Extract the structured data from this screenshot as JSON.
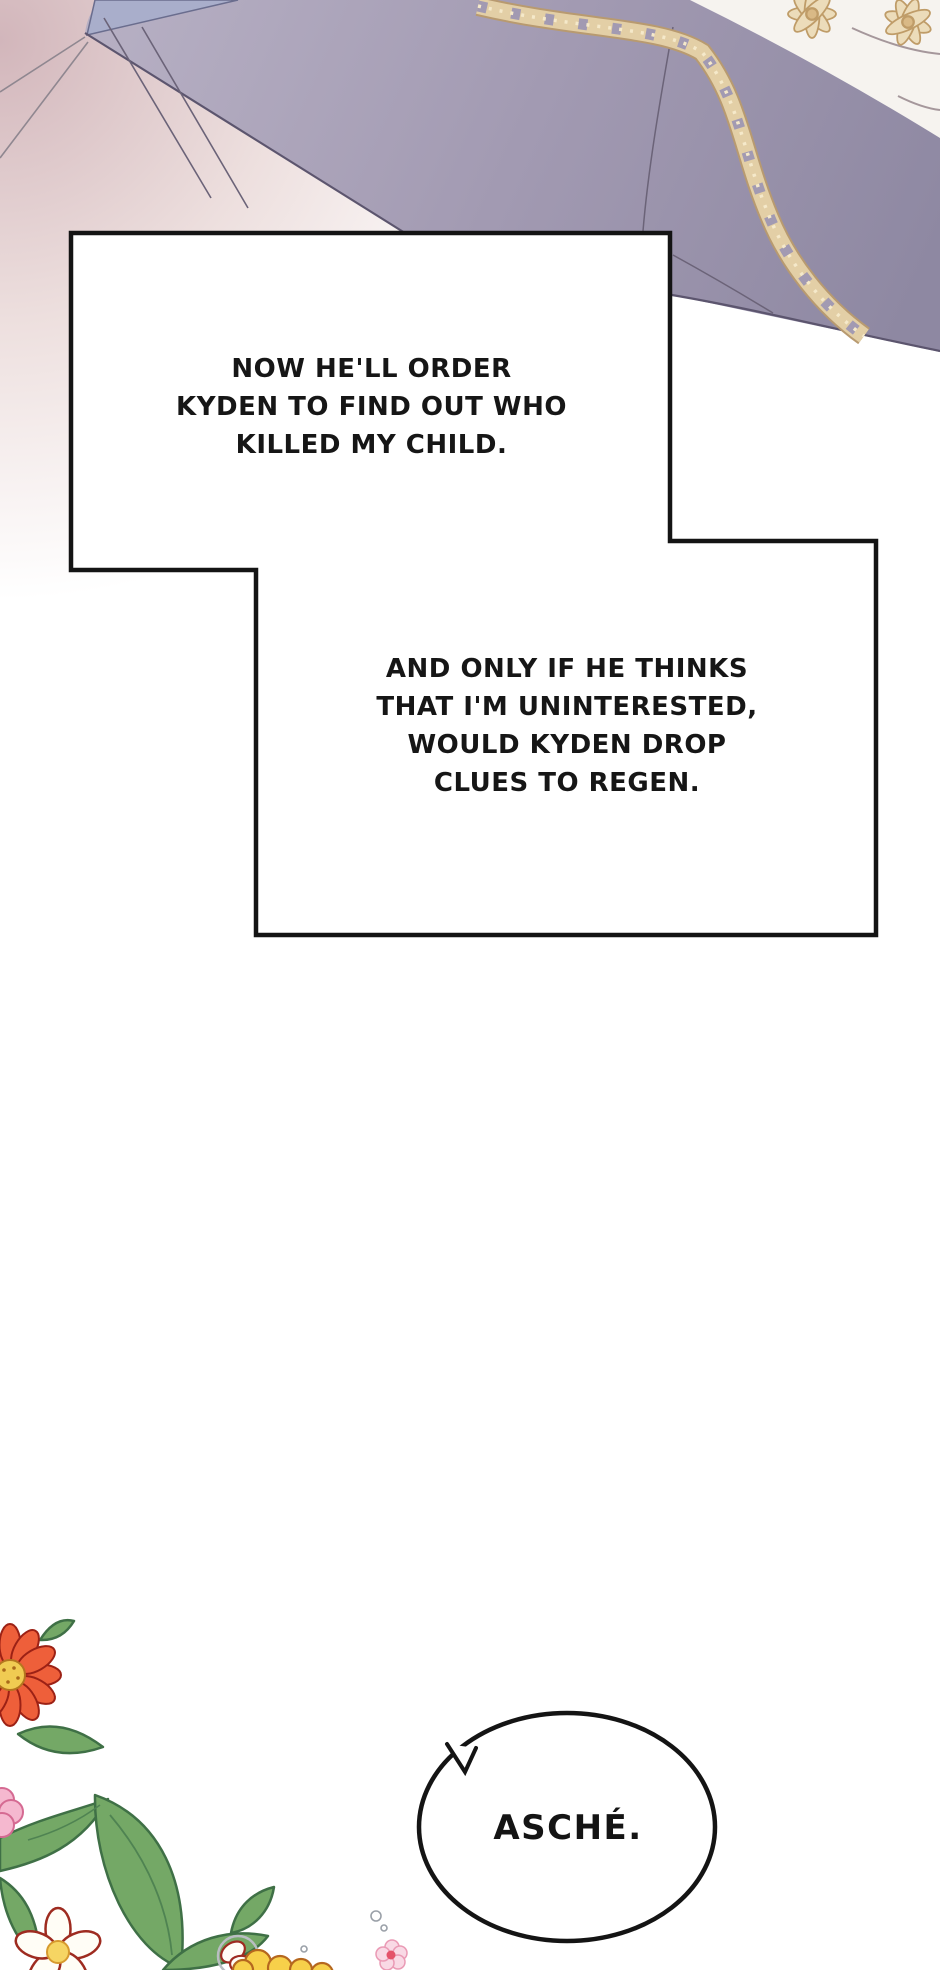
{
  "narration": {
    "box1": {
      "lines": [
        "NOW HE'LL ORDER",
        "KYDEN TO FIND OUT WHO",
        "KILLED MY CHILD."
      ]
    },
    "box2": {
      "lines": [
        "AND ONLY IF HE THINKS",
        "THAT I'M UNINTERESTED,",
        "WOULD KYDEN DROP",
        "CLUES TO REGEN."
      ]
    }
  },
  "speech": {
    "bubble_text": "ASCHÉ."
  },
  "colors": {
    "background": "#ffffff",
    "background_blush": "#d2b6bb",
    "coat_light": "#b6afc3",
    "coat_mid": "#a29ab2",
    "coat_dark": "#8e88a2",
    "coat_outline": "#5c556e",
    "collar_blue": "#a9aecb",
    "shirt_white": "#f6f3ef",
    "gold_trim": "#e3cfa6",
    "gold_trim_dark": "#b89a70",
    "gold_trim_light": "#f5e9ca",
    "panel_border": "#141414",
    "panel_fill": "#ffffff",
    "text_color": "#161616",
    "leaf_green": "#74a866",
    "leaf_outline": "#3f7046",
    "flower_red": "#ee5f3a",
    "flower_red_outline": "#9c2115",
    "flower_center_yellow": "#f0cb52",
    "flower_pink": "#f5b8cf",
    "flower_yellow": "#f7d04a",
    "flower_white": "#fffdf6"
  }
}
